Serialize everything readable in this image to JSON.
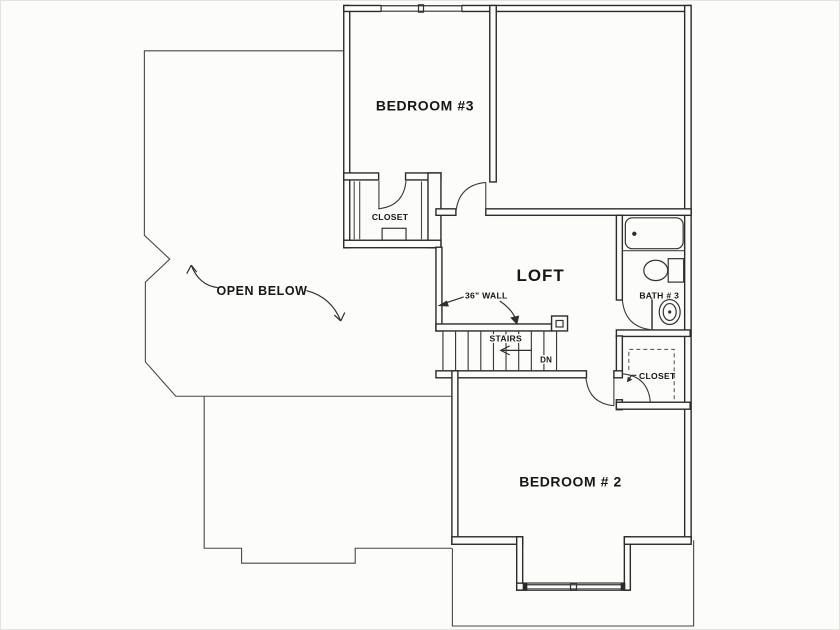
{
  "plan": {
    "type": "second-floor residential floor plan",
    "rooms": {
      "bedroom3": {
        "label": "BEDROOM #3"
      },
      "bedroom2": {
        "label": "BEDROOM # 2"
      },
      "loft": {
        "label": "LOFT"
      },
      "bath3": {
        "label": "BATH # 3"
      },
      "closet_bedroom3": {
        "label": "CLOSET"
      },
      "closet_hall": {
        "label": "CLOSET"
      },
      "open_below": {
        "label": "OPEN BELOW"
      }
    },
    "annotations": {
      "stairs_label": "STAIRS",
      "stairs_direction": "DN",
      "wall_note": "36\" WALL"
    },
    "fixtures": [
      "bathtub",
      "toilet",
      "sink",
      "stairs",
      "window",
      "door-swing",
      "closet-shelves",
      "newel-post"
    ],
    "colors": {
      "wall_line": "#2b2b2b",
      "thin_outline": "#474747",
      "background": "#fcfcfb",
      "text": "#161616"
    }
  }
}
